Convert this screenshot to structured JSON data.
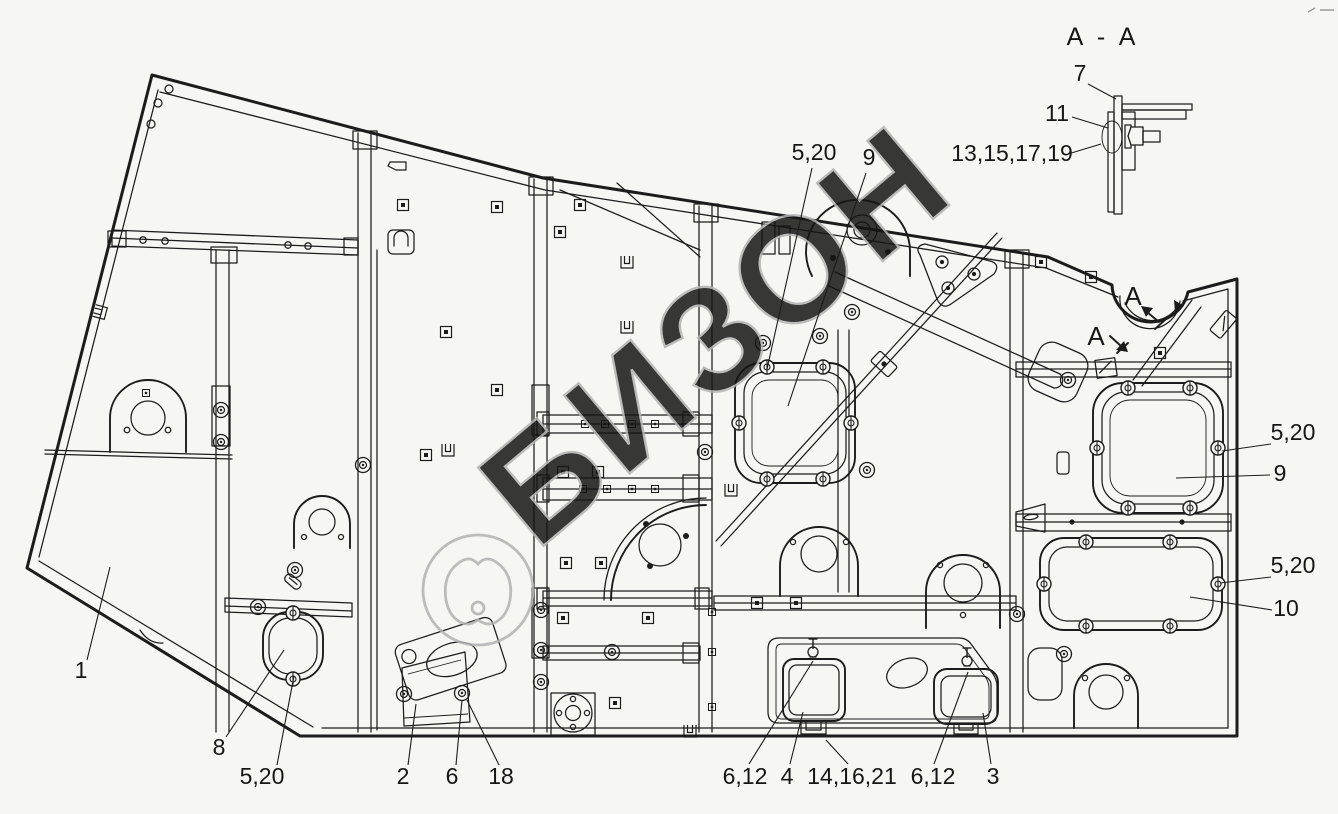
{
  "meta": {
    "background": "#f6f6f3",
    "ink_color": "#1c1c1c",
    "watermark_color": "#b2b2b2",
    "label_color": "#161616"
  },
  "watermark": {
    "text": "БИЗОН",
    "logo": "bizon-cattle-logo"
  },
  "corner_mark": {
    "glyph": "~ -"
  },
  "section_detail": {
    "title": "A - A"
  },
  "section_markers": [
    {
      "label": "A",
      "x": 1133,
      "y": 305
    },
    {
      "label": "A",
      "x": 1096,
      "y": 345
    }
  ],
  "callouts": [
    {
      "label": "1",
      "x": 81,
      "y": 678,
      "leader": [
        [
          87,
          660
        ],
        [
          110,
          567
        ]
      ]
    },
    {
      "label": "8",
      "x": 219,
      "y": 755,
      "leader": [
        [
          226,
          737
        ],
        [
          284,
          650
        ]
      ]
    },
    {
      "label": "5,20",
      "x": 262,
      "y": 784,
      "leader": [
        [
          277,
          765
        ],
        [
          294,
          676
        ]
      ]
    },
    {
      "label": "2",
      "x": 403,
      "y": 784,
      "leader": [
        [
          408,
          765
        ],
        [
          416,
          704
        ]
      ]
    },
    {
      "label": "6",
      "x": 452,
      "y": 784,
      "leader": [
        [
          456,
          765
        ],
        [
          462,
          700
        ]
      ]
    },
    {
      "label": "18",
      "x": 501,
      "y": 784,
      "leader": [
        [
          499,
          765
        ],
        [
          467,
          700
        ]
      ]
    },
    {
      "label": "6,12",
      "x": 745,
      "y": 784,
      "leader": [
        [
          749,
          764
        ],
        [
          813,
          661
        ]
      ]
    },
    {
      "label": "4",
      "x": 787,
      "y": 784,
      "leader": [
        [
          790,
          764
        ],
        [
          803,
          712
        ]
      ]
    },
    {
      "label": "14,16,21",
      "x": 852,
      "y": 784,
      "leader": [
        [
          848,
          764
        ],
        [
          826,
          740
        ]
      ]
    },
    {
      "label": "6,12",
      "x": 933,
      "y": 784,
      "leader": [
        [
          934,
          764
        ],
        [
          968,
          672
        ]
      ]
    },
    {
      "label": "3",
      "x": 993,
      "y": 784,
      "leader": [
        [
          991,
          764
        ],
        [
          983,
          713
        ]
      ]
    },
    {
      "label": "5,20",
      "x": 814,
      "y": 160,
      "leader": [
        [
          812,
          168
        ],
        [
          767,
          369
        ]
      ]
    },
    {
      "label": "9",
      "x": 869,
      "y": 165,
      "leader": [
        [
          866,
          173
        ],
        [
          788,
          406
        ]
      ]
    },
    {
      "label": "5,20",
      "x": 1293,
      "y": 440,
      "leader": [
        [
          1271,
          444
        ],
        [
          1222,
          451
        ]
      ]
    },
    {
      "label": "9",
      "x": 1280,
      "y": 481,
      "leader": [
        [
          1270,
          475
        ],
        [
          1176,
          478
        ]
      ]
    },
    {
      "label": "5,20",
      "x": 1293,
      "y": 573,
      "leader": [
        [
          1271,
          577
        ],
        [
          1220,
          583
        ]
      ]
    },
    {
      "label": "10",
      "x": 1286,
      "y": 616,
      "leader": [
        [
          1272,
          610
        ],
        [
          1190,
          597
        ]
      ]
    },
    {
      "label": "7",
      "x": 1080,
      "y": 81,
      "leader": [
        [
          1088,
          84
        ],
        [
          1116,
          99
        ]
      ]
    },
    {
      "label": "11",
      "x": 1057,
      "y": 121,
      "leader": [
        [
          1072,
          117
        ],
        [
          1108,
          128
        ]
      ]
    },
    {
      "label": "13,15,17,19",
      "x": 1012,
      "y": 161,
      "leader": [
        [
          1068,
          154
        ],
        [
          1101,
          144
        ]
      ]
    }
  ]
}
